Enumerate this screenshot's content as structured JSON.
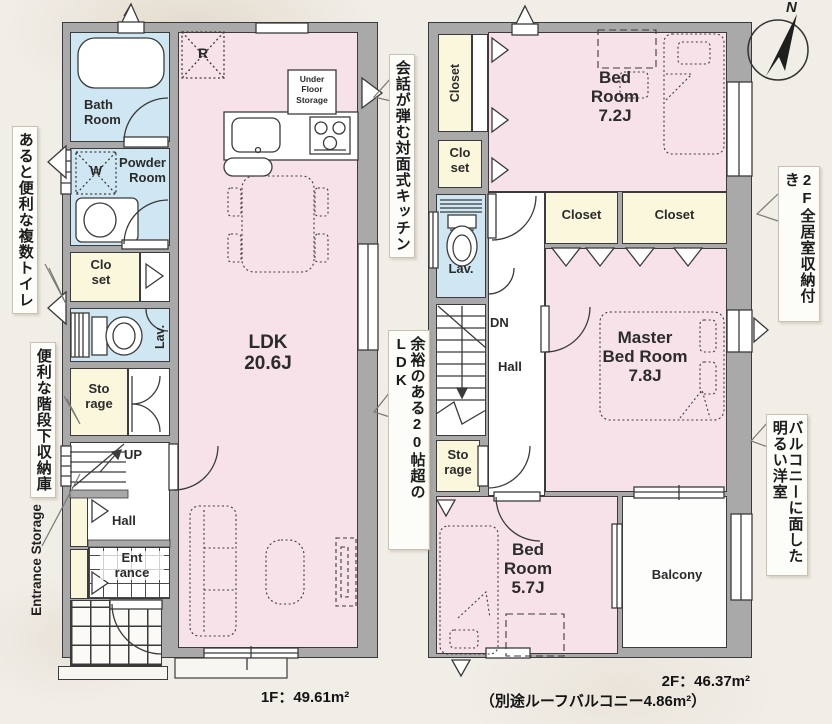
{
  "compass": {
    "north_label": "N"
  },
  "annotations": {
    "multi_toilet": "あると便利な複数トイレ",
    "under_stair": "便利な階段下収納庫",
    "entrance_storage": "Entrance Storage",
    "kitchen": "会話が弾む対面式キッチン",
    "ldk": "余裕のある20帖超のLDK",
    "storage_2f": "2F全居室収納付き",
    "balcony_room": "バルコニーに面した明るい洋室"
  },
  "floor1": {
    "area_label": "1F：49.61m²",
    "labels": {
      "bath": "Bath\nRoom",
      "washer": "W",
      "powder": "Powder\nRoom",
      "fridge": "R",
      "under_floor_storage": "Under\nFloor\nStorage",
      "closet": "Clo\nset",
      "lav": "Lav.",
      "storage": "Sto\nrage",
      "up": "UP",
      "hall": "Hall",
      "entrance": "Ent\nrance",
      "ldk": "LDK\n20.6J"
    }
  },
  "floor2": {
    "area_label": "2F：46.37m²",
    "area_note": "（別途ルーフバルコニー4.86m²）",
    "labels": {
      "closet_tall": "Closet",
      "closet_small": "Clo\nset",
      "bedroom1": "Bed\nRoom\n7.2J",
      "closet_m1": "Closet",
      "closet_m2": "Closet",
      "lav": "Lav.",
      "dn": "DN",
      "hall": "Hall",
      "master": "Master\nBed Room\n7.8J",
      "storage": "Sto\nrage",
      "bedroom2": "Bed\nRoom\n5.7J",
      "balcony": "Balcony"
    }
  }
}
